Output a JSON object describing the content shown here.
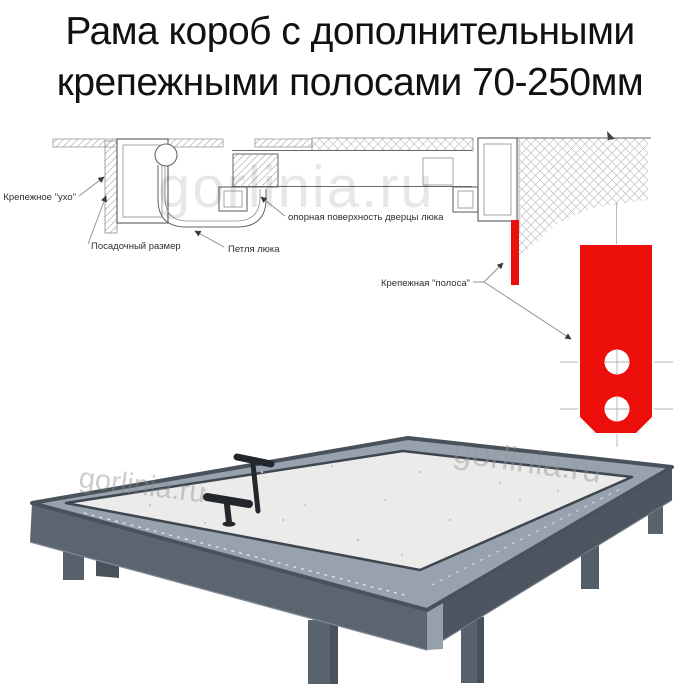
{
  "page": {
    "background": "#ffffff"
  },
  "title": {
    "line1": "Рама короб с дополнительными",
    "line2": "крепежными полосами 70-250мм"
  },
  "diagram": {
    "labels": {
      "ear": "Крепежное \"ухо\"",
      "mount_size": "Посадочный размер",
      "hinge": "Петля люка",
      "door_support": "опорная поверхность дверцы люка",
      "strip": "Крепежная \"полоса\""
    },
    "colors": {
      "strip_red": "#ec0f0c",
      "line_gray": "#666666",
      "hatch_gray": "#aaafb5"
    }
  },
  "photo": {
    "colors": {
      "frame_flange": "#98a2af",
      "frame_side_front": "#5b6570",
      "frame_side_right": "#4d5660",
      "panel_white": "#ebecea",
      "handle_black": "#23272c",
      "leg_gray": "#58626c"
    }
  },
  "watermark": {
    "text": "gorlinia.ru"
  }
}
